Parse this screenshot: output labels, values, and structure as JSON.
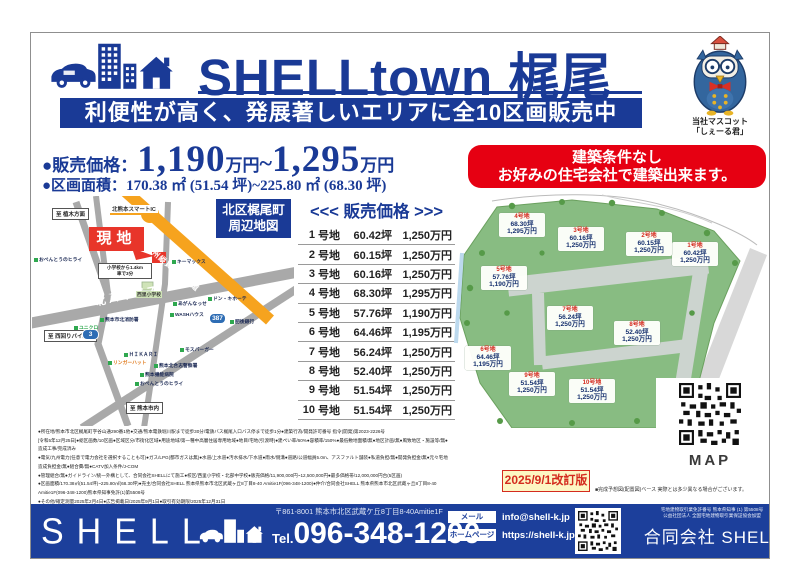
{
  "colors": {
    "brand_navy": "#1a3a96",
    "accent_red": "#e60012",
    "highway_orange": "#f6a31e",
    "siteplan_green": "#88bc82",
    "footer_blue": "#1c3f9b",
    "revision_yellow": "#fdf6c3"
  },
  "header": {
    "title": "SHELLtown 梶尾",
    "tagline": "利便性が高く、発展著しいエリアに全10区画販売中",
    "mascot_caption1": "当社マスコット",
    "mascot_caption2": "「しぇーる君」"
  },
  "pricing": {
    "price_label": "●販売価格：",
    "price_min": "1,190",
    "price_min_unit": "万円",
    "price_tilde": "~",
    "price_max": "1,295",
    "price_max_unit": "万円",
    "area_label": "●区画面積：",
    "area_value": "170.38 ㎡ (51.54 坪)~225.80 ㎡ (68.30 坪)"
  },
  "highlight": {
    "line1": "建築条件なし",
    "line2": "お好みの住宅会社で建築出来ます。"
  },
  "map": {
    "title_line1": "北区梶尾町",
    "title_line2": "周辺地図",
    "site_label": "現地",
    "smart_ic": "北熊本スマートIC",
    "highway_label": "九州縦貫自動車道",
    "bypass_label": "北バイパス",
    "route3": "3",
    "route387": "387",
    "dest_north": "至 植木方面",
    "dest_west": "至 西回りバイパス",
    "dest_south": "至 熊本市内",
    "school_note1": "小学校から1.4km",
    "school_note2": "車で3分",
    "pois": [
      "キーマックス",
      "あがんなっせ",
      "WASHハウス",
      "ドン・キホーテ",
      "肥後銀行",
      "モスバーガー",
      "ＨＩＫＡＲＩ",
      "リンガーハット",
      "熊本北合志警察署",
      "熊本機能病院",
      "おべんとうのヒライ",
      "おべんとうのヒライ",
      "ユニクロ",
      "熊本市北消防署",
      "西里小学校"
    ]
  },
  "price_table": {
    "title": "<<< 販売価格 >>>",
    "rows": [
      {
        "no": "1",
        "unit": "号地",
        "area": "60.42坪",
        "price": "1,250万円"
      },
      {
        "no": "2",
        "unit": "号地",
        "area": "60.15坪",
        "price": "1,250万円"
      },
      {
        "no": "3",
        "unit": "号地",
        "area": "60.16坪",
        "price": "1,250万円"
      },
      {
        "no": "4",
        "unit": "号地",
        "area": "68.30坪",
        "price": "1,295万円"
      },
      {
        "no": "5",
        "unit": "号地",
        "area": "57.76坪",
        "price": "1,190万円"
      },
      {
        "no": "6",
        "unit": "号地",
        "area": "64.46坪",
        "price": "1,195万円"
      },
      {
        "no": "7",
        "unit": "号地",
        "area": "56.24坪",
        "price": "1,250万円"
      },
      {
        "no": "8",
        "unit": "号地",
        "area": "52.40坪",
        "price": "1,250万円"
      },
      {
        "no": "9",
        "unit": "号地",
        "area": "51.54坪",
        "price": "1,250万円"
      },
      {
        "no": "10",
        "unit": "号地",
        "area": "51.54坪",
        "price": "1,250万円"
      }
    ]
  },
  "siteplan": {
    "lots": [
      {
        "name": "1号地",
        "area": "60.42坪",
        "price": "1,250万円"
      },
      {
        "name": "2号地",
        "area": "60.15坪",
        "price": "1,250万円"
      },
      {
        "name": "3号地",
        "area": "60.16坪",
        "price": "1,250万円"
      },
      {
        "name": "4号地",
        "area": "68.30坪",
        "price": "1,295万円"
      },
      {
        "name": "5号地",
        "area": "57.76坪",
        "price": "1,190万円"
      },
      {
        "name": "6号地",
        "area": "64.46坪",
        "price": "1,195万円"
      },
      {
        "name": "7号地",
        "area": "56.24坪",
        "price": "1,250万円"
      },
      {
        "name": "8号地",
        "area": "52.40坪",
        "price": "1,250万円"
      },
      {
        "name": "9号地",
        "area": "51.54坪",
        "price": "1,250万円"
      },
      {
        "name": "10号地",
        "area": "51.54坪",
        "price": "1,250万円"
      }
    ],
    "qr_label": "MAP",
    "revision": "2025/9/1改訂版",
    "note": "■完成予想図(配置図)ベース 実際とは多少異なる場合がございます。"
  },
  "fine_print": {
    "lines": [
      "●所在地/熊本市北区梶尾町字谷山通290番1他●交通/熊本電鉄堀川駅まで徒歩30分/電鉄バス梶尾入口バス停まで徒歩1分●建築行為/開発許可番号 指令(開発)第2023-2226号",
      "[令和5年12月25日]●総区画数/10区画●区域区分/市街化区域●用途地域/第一種中高層住居専用地域●地目/宅地(引渡時)●建ぺい率/60%●容積率/150%●最低敷地面積/無●地区計画/無●風致地区・施設等/無●造成工事/完成済み",
      "●電気/九州電力(任意で電力会社を選択することも可)●ガス/LPG(都市ガスは無)●水道/上水道●汚水排水/下水道●雨水/側溝●道路/公道幅員5.0m、アスファルト舗装●私道負担/無●開発負担金/無●元々宅地造成負担金/無●組合費/無●CATV加入条件/J-COM",
      "●管理組合/無●ガイドライン/統一外構として、合同会社SHELLにて施工●校区/西里小学校・北部中学校●販売価格/11,900,000円~12,500,000円●最多価格帯/12,000,000円台(5区画)",
      "●区画面積/170.38㎡(51.54坪)~225.80㎡(68.30坪)●売主/合同会社SHELL 熊本県熊本市北区武蔵ヶ丘8丁目8-40 Amitie1F(096-348-1200)●仲介/合同会社SHELL 熊本県熊本市北区武蔵ヶ丘8丁目8-40 Amitie1F(096-348-1200)熊本県知事免許(1)第5508号",
      "●その他/確定測量2025年2月4日●広告掲載日/2025年9月1日●取引有効期限/2025年12月31日"
    ]
  },
  "footer": {
    "brand": "SHELL",
    "address": "〒861-8001 熊本市北区武蔵ケ丘8丁目8-40Amitie1F",
    "tel_label": "Tel.",
    "tel_number": "096-348-1200",
    "mail_label": "メール",
    "mail_value": "info@shell-k.jp",
    "web_label": "ホームページ",
    "web_value": "https://shell-k.jp",
    "license1": "宅地建物取引業免許番号 熊本県知事 (1) 第5508号",
    "license2": "公益社団法人 全国宅地建物取引業保証協会加盟",
    "company": "合同会社 SHELL"
  }
}
